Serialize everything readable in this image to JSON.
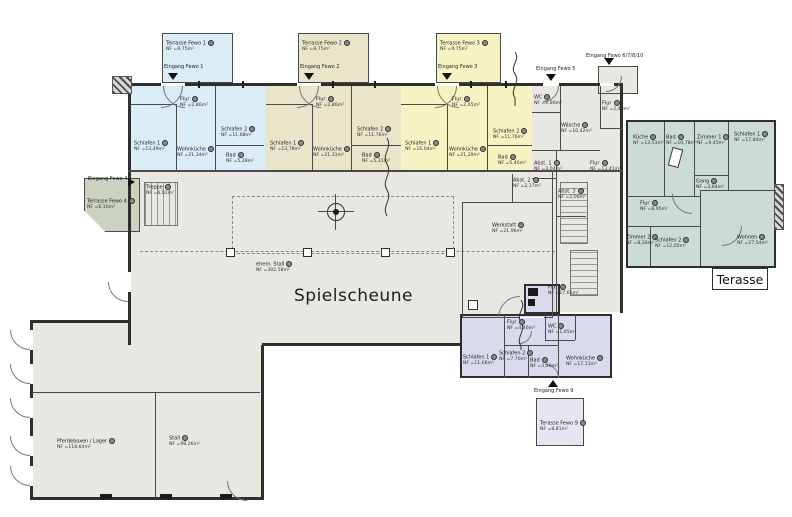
{
  "colors": {
    "fewo1_blue": "#daecf5",
    "fewo2_tan": "#e9e5c9",
    "fewo3_yellow": "#f6f3c3",
    "hall_gray": "#e9e7e2",
    "fewo10_teal": "#cbdcd5",
    "fewo9_purple": "#dadaee",
    "fewo4_green": "#ccd2c0"
  },
  "hall": {
    "title": "Spielscheune",
    "sub": {
      "n": "ehem. Stall",
      "a": "NF =392,58m²"
    }
  },
  "terraces": {
    "t1": {
      "title": "Terrasse Fewo 1",
      "area": "NF =9,75m²",
      "entrance": "Eingang Fewo 1"
    },
    "t2": {
      "title": "Terrasse Fewo 2",
      "area": "NF =9,75m²",
      "entrance": "Eingang Fewo 2"
    },
    "t3": {
      "title": "Terrasse Fewo 3",
      "area": "NF =9,75m²",
      "entrance": "Eingang Fewo 3"
    },
    "t4": {
      "title": "Terrasse Fewo 4",
      "area": "NF =6,16m²",
      "entrance": "Eingang Fewo 4"
    },
    "t9": {
      "title": "Terasse Fewo 9",
      "area": "NF =8,81m²",
      "entrance": "Eingang Fewo 9"
    }
  },
  "entrances": {
    "e5": "Eingang Fewo 5",
    "e6": "Eingang Fewo 6/7/8/10"
  },
  "fewo1": {
    "flur": {
      "n": "Flur",
      "a": "NF =2,86m²"
    },
    "schlafen1": {
      "n": "Schlafen 1",
      "a": "NF =13,49m²"
    },
    "wohnkueche": {
      "n": "Wohnküche",
      "a": "NF =21,34m²"
    },
    "schlafen2": {
      "n": "Schlafen 2",
      "a": "NF =11,68m²"
    },
    "bad": {
      "n": "Bad",
      "a": "NF =5,28m²"
    }
  },
  "fewo2": {
    "flur": {
      "n": "Flur",
      "a": "NF =2,86m²"
    },
    "schlafen1": {
      "n": "Schlafen 1",
      "a": "NF =13,78m²"
    },
    "wohnkueche": {
      "n": "Wohnküche",
      "a": "NF =21,31m²"
    },
    "schlafen2": {
      "n": "Schlafen 2",
      "a": "NF =11,76m²"
    },
    "bad": {
      "n": "Bad",
      "a": "NF =5,31m²"
    }
  },
  "fewo3": {
    "flur": {
      "n": "Flur",
      "a": "NF =2,65m²"
    },
    "schlafen1": {
      "n": "Schlafen 1",
      "a": "NF =16,04m²"
    },
    "wohnkueche": {
      "n": "Wohnküche",
      "a": "NF =21,29m²"
    },
    "schlafen2": {
      "n": "Schlafen 2",
      "a": "NF =11,76m²"
    },
    "bad": {
      "n": "Bad",
      "a": "NF =5,46m²"
    }
  },
  "service": {
    "wc": {
      "n": "WC",
      "a": "NF =0,86m²"
    },
    "waesche": {
      "n": "Wäsche",
      "a": "NF =10,42m²"
    },
    "flur1": {
      "n": "Flur",
      "a": "NF =2,48m²"
    },
    "abst1": {
      "n": "Abst. 1",
      "a": "NF =3,04m²"
    },
    "abst2": {
      "n": "Abst. 2",
      "a": "NF =2,17m²"
    },
    "abst3": {
      "n": "Abst. 3",
      "a": "NF =2,08m²"
    },
    "flur2": {
      "n": "Flur",
      "a": "NF =13,41m²"
    },
    "flur3": {
      "n": "Flur",
      "a": "NF =17,61m²"
    },
    "treppe": {
      "n": "Treppe",
      "a": "NF =6,02m²"
    },
    "werkstatt": {
      "n": "Werkstatt",
      "a": "NF =21,96m²"
    }
  },
  "fewo10": {
    "kueche": {
      "n": "Küche",
      "a": "NF =13,51m²"
    },
    "bad": {
      "n": "Bad",
      "a": "NF =10,78m²"
    },
    "zimmer1": {
      "n": "Zimmer 1",
      "a": "NF =9,45m²"
    },
    "schlafen1": {
      "n": "Schlafen 1",
      "a": "NF =17,84m²"
    },
    "gang": {
      "n": "Gang",
      "a": "NF =3,64m²"
    },
    "flur": {
      "n": "Flur",
      "a": "NF =8,95m²"
    },
    "zimmer2": {
      "n": "Zimmer 2",
      "a": "NF =8,28m²"
    },
    "schlafen2": {
      "n": "Schlafen 2",
      "a": "NF =12,05m²"
    },
    "wohnen": {
      "n": "Wohnen",
      "a": "NF =27,54m²"
    },
    "terrasse": "Terasse"
  },
  "fewo9": {
    "flur": {
      "n": "Flur",
      "a": "NF =4,46m²"
    },
    "wc": {
      "n": "WC",
      "a": "NF =1,65m²"
    },
    "schlafen1": {
      "n": "Schlafen 1",
      "a": "NF =11,66m²"
    },
    "schlafen2": {
      "n": "Schlafen 2",
      "a": "NF =7,76m²"
    },
    "bad": {
      "n": "Bad",
      "a": "NF =3,20m²"
    },
    "wohnkueche": {
      "n": "Wohnküche",
      "a": "NF =17,11m²"
    }
  },
  "barn": {
    "pferdeboxen": {
      "n": "Pferdeboxen / Lager",
      "a": "NF =118,64m²"
    },
    "stall": {
      "n": "Stall",
      "a": "NF =98,26m²"
    }
  }
}
